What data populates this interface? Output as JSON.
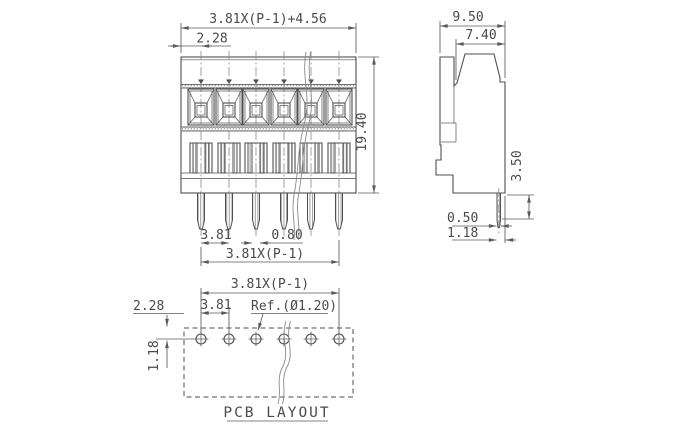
{
  "drawing": {
    "front_view": {
      "positions": 6,
      "dim_total_width": "3.81X(P-1)+4.56",
      "dim_edge_to_pin": "2.28",
      "dim_height": "19.40",
      "dim_pitch": "3.81",
      "dim_pin_width": "0.80",
      "dim_pin_span": "3.81X(P-1)"
    },
    "side_view": {
      "dim_depth": "9.50",
      "dim_top_depth": "7.40",
      "dim_pin_length": "3.50",
      "dim_pin_thickness": "0.50",
      "dim_pin_to_edge": "1.18"
    },
    "pcb_layout": {
      "title": "PCB LAYOUT",
      "hole_count": 6,
      "dim_hole_span": "3.81X(P-1)",
      "dim_edge_offset": "2.28",
      "dim_hole_pitch": "3.81",
      "hole_diameter_ref": "Ref.(Ø1.20)",
      "dim_row_offset": "1.18"
    },
    "colors": {
      "line": "#4f4f4f",
      "dim": "#5a5a5a",
      "text": "#4a4a4a",
      "centerline": "#8b8b8b",
      "hatch": "#9c9c9c",
      "background": "#ffffff"
    }
  }
}
